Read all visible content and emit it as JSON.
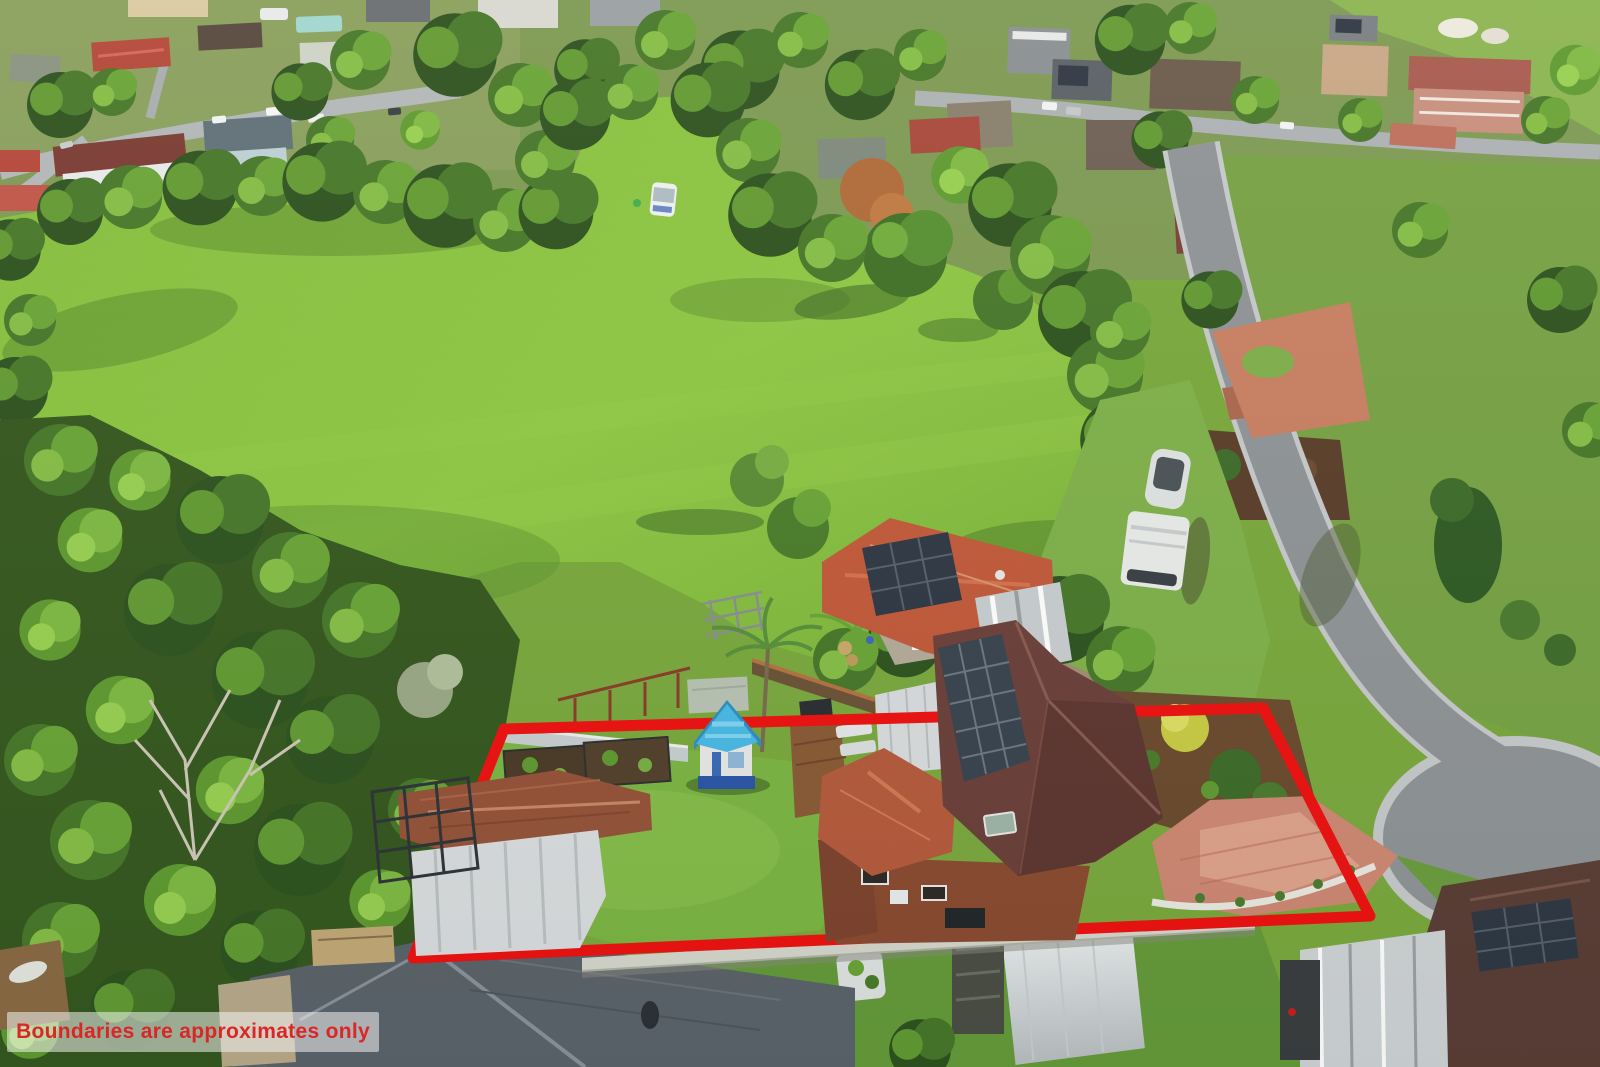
{
  "overlay": {
    "disclaimer": "Boundaries are approximates only"
  },
  "theme": {
    "boundary_red": "#ee1111",
    "disclaimer_red": "#e62629",
    "panel_color": "rgba(255,255,255,0.55)",
    "field_green": "#8cc63f",
    "lawn_green": "#7cb544",
    "road_grey": "#95989b",
    "roof_maroon": "#6b3c36",
    "roof_orange": "#c25c3a",
    "brick_red": "#8c4a31",
    "cubby_blue": "#49b9e6",
    "driveway_pink": "#cf8874"
  },
  "boundary": {
    "points": "504,729 1263,708 1370,916 413,958",
    "stroke_width": "11"
  }
}
